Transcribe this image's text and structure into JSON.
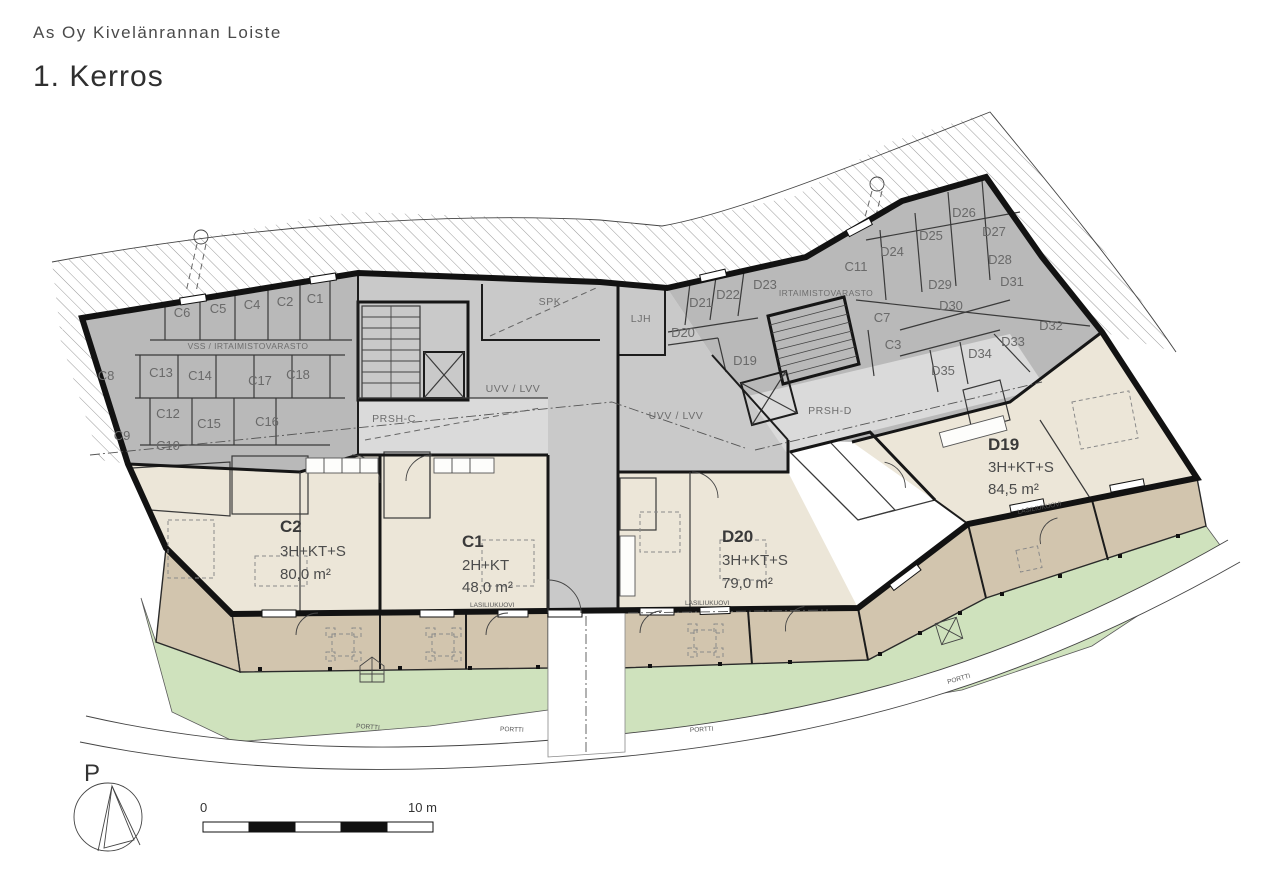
{
  "header": {
    "project": "As Oy Kivelänrannan Loiste",
    "floor": "1. Kerros"
  },
  "apartments": [
    {
      "id": "C2",
      "layout": "3H+KT+S",
      "area": "80,0 m²"
    },
    {
      "id": "C1",
      "layout": "2H+KT",
      "area": "48,0 m²"
    },
    {
      "id": "D20",
      "layout": "3H+KT+S",
      "area": "79,0 m²"
    },
    {
      "id": "D19",
      "layout": "3H+KT+S",
      "area": "84,5 m²"
    }
  ],
  "storage": {
    "c_units": [
      "C6",
      "C5",
      "C4",
      "C2",
      "C1",
      "C8",
      "C13",
      "C14",
      "C17",
      "C18",
      "C12",
      "C15",
      "C16",
      "C9",
      "C10"
    ],
    "d_mid_units": [
      "D21",
      "D22",
      "D23",
      "D20",
      "D19"
    ],
    "ne_units": [
      "C11",
      "D24",
      "D25",
      "D26",
      "D27",
      "D28",
      "D29",
      "D30",
      "D31",
      "C7",
      "C3",
      "D32",
      "D33",
      "D34",
      "D35"
    ]
  },
  "rooms": {
    "vss": "VSS / IRTAIMISTOVARASTO",
    "irtaimisto": "IRTAIMISTOVARASTO",
    "uvv_lvv": "UVV / LVV",
    "spk": "SPK",
    "ljh": "LJH",
    "prsh_c": "PRSH-C",
    "prsh_d": "PRSH-D"
  },
  "annotations": {
    "portti": "PORTTI",
    "lasiliukuovi": "LASILIUKUOVI",
    "north": "P",
    "scale_start": "0",
    "scale_end": "10 m"
  },
  "colors": {
    "storage_fill": "#b9b9b9",
    "corridor_fill": "#c9c9c9",
    "hall_fill": "#dadada",
    "apartment_fill": "#ece6d8",
    "terrace_fill": "#d2c5ae",
    "yard_fill": "#cfe2bd",
    "bathroom_fill": "#d8ecf2",
    "wall": "#121212"
  }
}
